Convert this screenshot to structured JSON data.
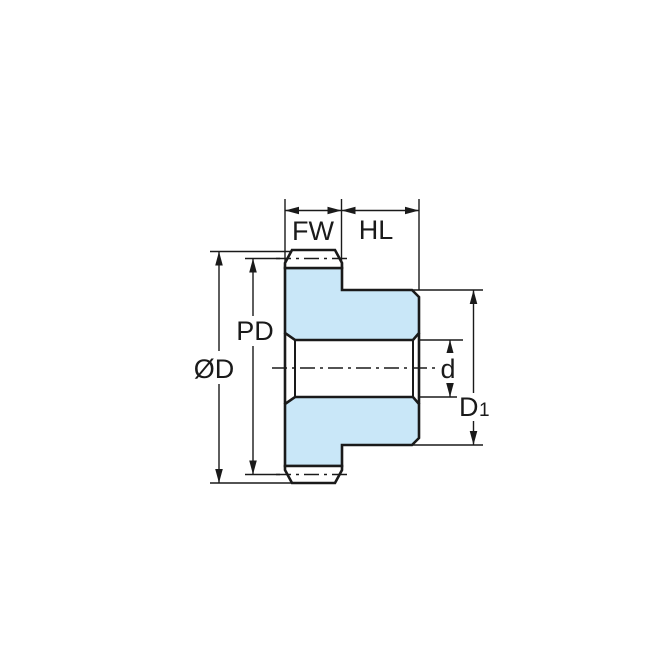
{
  "diagram": {
    "labels": {
      "face_width": "FW",
      "hub_length": "HL",
      "pitch_diameter": "PD",
      "outside_diameter": "ØD",
      "bore_diameter": "d",
      "hub_diameter_main": "D",
      "hub_diameter_sub": "1"
    },
    "colors": {
      "part_fill": "#C9E7F8",
      "line": "#1A1A1A",
      "background": "#FFFFFF"
    }
  }
}
